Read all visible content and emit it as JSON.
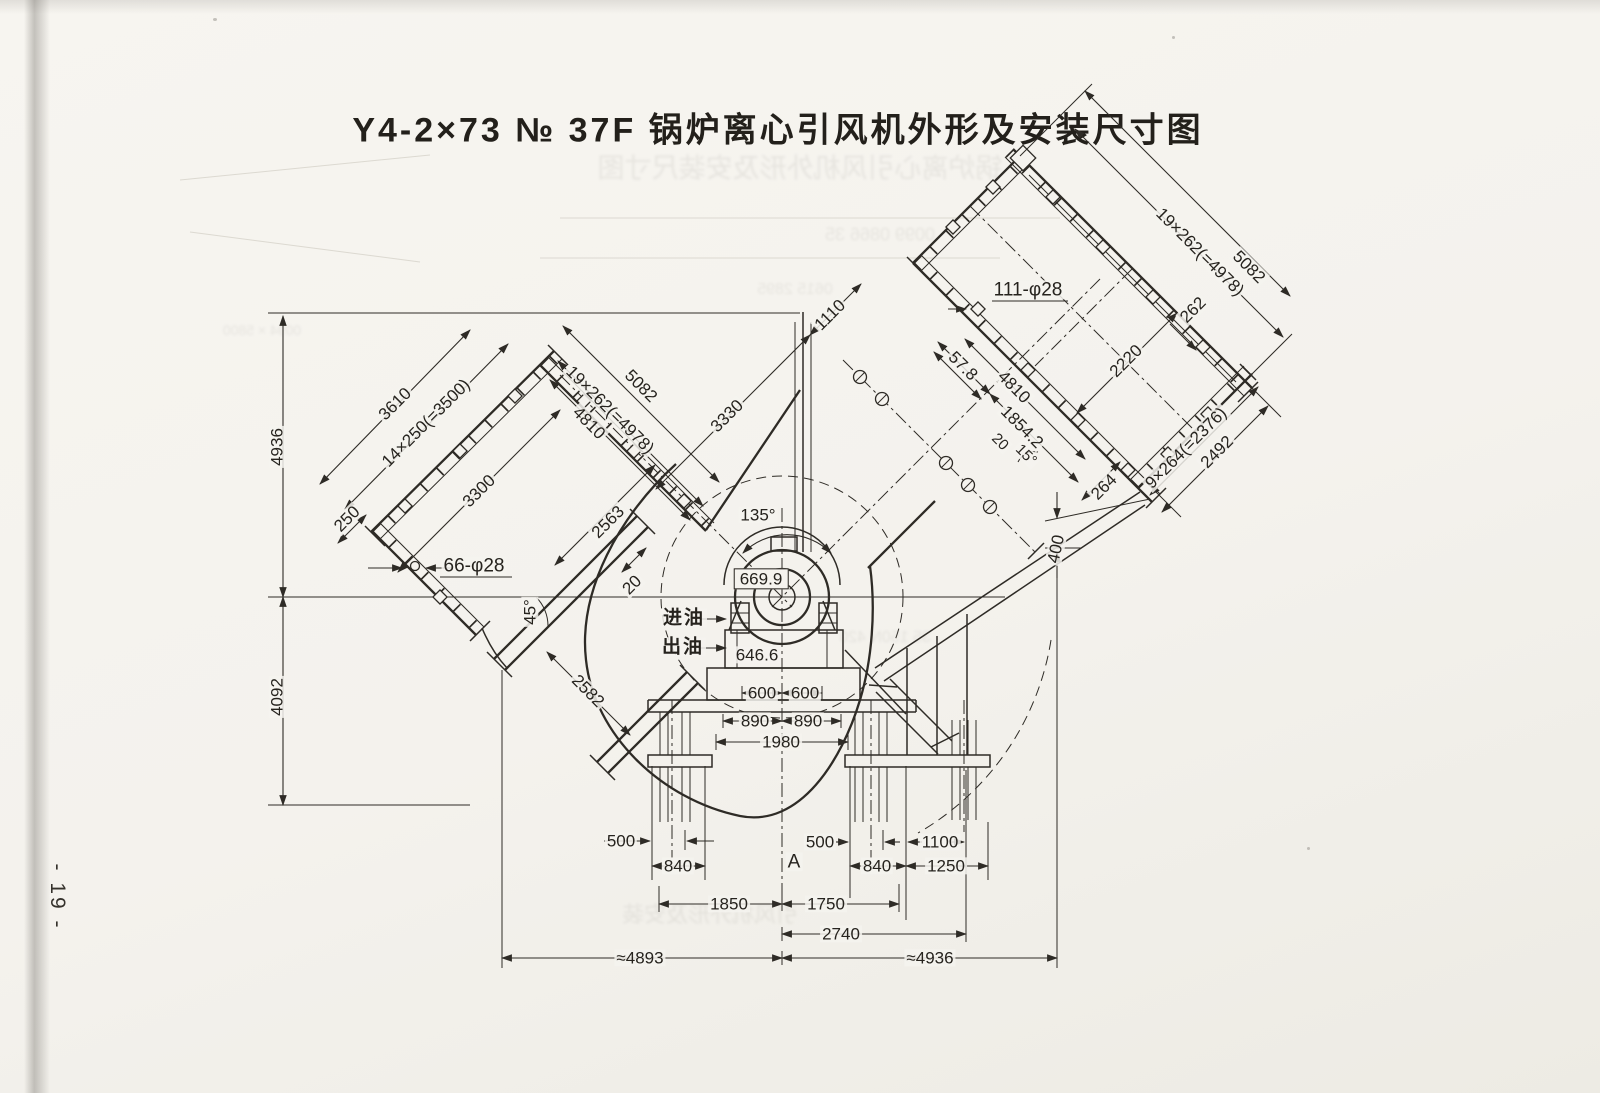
{
  "title": "Y4-2×73  № 37F  锅炉离心引风机外形及安装尺寸图",
  "page_number": "- 19 -",
  "drawing": {
    "ink_color": "#2e2b26",
    "paper_color": "#f4f2ed",
    "annotations": [
      {
        "id": "v4936",
        "text": "4936",
        "x": 277,
        "y": 447,
        "rot": -90
      },
      {
        "id": "v4092",
        "text": "4092",
        "x": 277,
        "y": 697,
        "rot": -90
      },
      {
        "id": "d3610",
        "text": "3610",
        "x": 395,
        "y": 404,
        "rot": -45
      },
      {
        "id": "d14x250",
        "text": "14×250(=3500)",
        "x": 426,
        "y": 423,
        "rot": -45
      },
      {
        "id": "d250",
        "text": "250",
        "x": 347,
        "y": 519,
        "rot": -45
      },
      {
        "id": "d3300",
        "text": "3300",
        "x": 479,
        "y": 491,
        "rot": -45
      },
      {
        "id": "d66phi",
        "text": "66-φ28",
        "x": 474,
        "y": 566,
        "rot": 0,
        "fs": 19
      },
      {
        "id": "d5082L",
        "text": "5082",
        "x": 641,
        "y": 386,
        "rot": 45
      },
      {
        "id": "d19x262L",
        "text": "19×262(=4978)",
        "x": 610,
        "y": 410,
        "rot": 45
      },
      {
        "id": "d4810L",
        "text": "4810",
        "x": 589,
        "y": 423,
        "rot": 45
      },
      {
        "id": "d2563",
        "text": "2563",
        "x": 608,
        "y": 522,
        "rot": -45
      },
      {
        "id": "d20L",
        "text": "20",
        "x": 632,
        "y": 585,
        "rot": -45
      },
      {
        "id": "d45",
        "text": "45°",
        "x": 530,
        "y": 612,
        "rot": -90
      },
      {
        "id": "d2582",
        "text": "2582",
        "x": 588,
        "y": 691,
        "rot": 45
      },
      {
        "id": "d3330",
        "text": "3330",
        "x": 727,
        "y": 416,
        "rot": -45
      },
      {
        "id": "d1110",
        "text": "1110",
        "x": 830,
        "y": 315,
        "rot": -45
      },
      {
        "id": "d135",
        "text": "135°",
        "x": 758,
        "y": 515,
        "rot": 0
      },
      {
        "id": "d669",
        "text": "669.9",
        "x": 761,
        "y": 579,
        "rot": 0,
        "cls": "box"
      },
      {
        "id": "oil-in",
        "text": "进油",
        "x": 684,
        "y": 618,
        "rot": 0,
        "fs": 19,
        "cls": "cjk"
      },
      {
        "id": "oil-out",
        "text": "出油",
        "x": 683,
        "y": 647,
        "rot": 0,
        "fs": 19,
        "cls": "cjk"
      },
      {
        "id": "d646",
        "text": "646.6",
        "x": 757,
        "y": 655,
        "rot": 0
      },
      {
        "id": "d600a",
        "text": "600",
        "x": 762,
        "y": 693,
        "rot": 0
      },
      {
        "id": "d600b",
        "text": "600",
        "x": 805,
        "y": 693,
        "rot": 0
      },
      {
        "id": "d890a",
        "text": "890",
        "x": 755,
        "y": 721,
        "rot": 0
      },
      {
        "id": "d890b",
        "text": "890",
        "x": 808,
        "y": 721,
        "rot": 0
      },
      {
        "id": "d1980",
        "text": "1980",
        "x": 781,
        "y": 742,
        "rot": 0
      },
      {
        "id": "d500a",
        "text": "500",
        "x": 621,
        "y": 841,
        "rot": 0
      },
      {
        "id": "d840a",
        "text": "840",
        "x": 678,
        "y": 866,
        "rot": 0
      },
      {
        "id": "ptA",
        "text": "A",
        "x": 794,
        "y": 862,
        "rot": 0,
        "fs": 19
      },
      {
        "id": "d500b",
        "text": "500",
        "x": 820,
        "y": 842,
        "rot": 0
      },
      {
        "id": "d840b",
        "text": "840",
        "x": 877,
        "y": 866,
        "rot": 0
      },
      {
        "id": "d1100",
        "text": "1100",
        "x": 940,
        "y": 842,
        "rot": 0
      },
      {
        "id": "d1250",
        "text": "1250",
        "x": 946,
        "y": 866,
        "rot": 0
      },
      {
        "id": "d1850",
        "text": "1850",
        "x": 729,
        "y": 904,
        "rot": 0
      },
      {
        "id": "d1750",
        "text": "1750",
        "x": 826,
        "y": 904,
        "rot": 0
      },
      {
        "id": "d2740",
        "text": "2740",
        "x": 841,
        "y": 934,
        "rot": 0
      },
      {
        "id": "d4893",
        "text": "≈4893",
        "x": 640,
        "y": 958,
        "rot": 0
      },
      {
        "id": "d4936b",
        "text": "≈4936",
        "x": 930,
        "y": 958,
        "rot": 0
      },
      {
        "id": "d111phi",
        "text": "111-φ28",
        "x": 1028,
        "y": 290,
        "rot": 0,
        "fs": 19
      },
      {
        "id": "d57",
        "text": "57.8",
        "x": 963,
        "y": 366,
        "rot": 45
      },
      {
        "id": "d4810R",
        "text": "4810",
        "x": 1014,
        "y": 387,
        "rot": 45
      },
      {
        "id": "d1854",
        "text": "1854.2",
        "x": 1022,
        "y": 427,
        "rot": 45
      },
      {
        "id": "d20R",
        "text": "20",
        "x": 1000,
        "y": 442,
        "rot": 45,
        "fs": 15
      },
      {
        "id": "d15",
        "text": "15°",
        "x": 1026,
        "y": 455,
        "rot": 45,
        "fs": 15
      },
      {
        "id": "d2220",
        "text": "2220",
        "x": 1126,
        "y": 361,
        "rot": -45
      },
      {
        "id": "d19x262R",
        "text": "19×262(=4978)",
        "x": 1200,
        "y": 252,
        "rot": 45
      },
      {
        "id": "d5082R",
        "text": "5082",
        "x": 1249,
        "y": 267,
        "rot": 45
      },
      {
        "id": "d262",
        "text": "262",
        "x": 1193,
        "y": 310,
        "rot": -45
      },
      {
        "id": "d9x264",
        "text": "9×264(=2376)",
        "x": 1186,
        "y": 448,
        "rot": -45
      },
      {
        "id": "d2492",
        "text": "2492",
        "x": 1217,
        "y": 452,
        "rot": -45
      },
      {
        "id": "d264",
        "text": "264",
        "x": 1104,
        "y": 487,
        "rot": -45
      },
      {
        "id": "d400",
        "text": "400",
        "x": 1056,
        "y": 549,
        "rot": -78
      }
    ]
  },
  "artifacts": {
    "ghosts": [
      {
        "text": "锅炉离心引风机外形及安装尺寸图",
        "x": 800,
        "y": 166,
        "fs": 27
      },
      {
        "text": "0099  0866  35",
        "x": 880,
        "y": 235,
        "fs": 18
      },
      {
        "text": "0615   2895",
        "x": 795,
        "y": 290,
        "fs": 16
      },
      {
        "text": "35  150N  420",
        "x": 885,
        "y": 638,
        "fs": 16
      },
      {
        "text": "引风机外形及安装",
        "x": 710,
        "y": 913,
        "fs": 22
      },
      {
        "text": "0094 × 5800",
        "x": 262,
        "y": 330,
        "fs": 14
      }
    ]
  }
}
